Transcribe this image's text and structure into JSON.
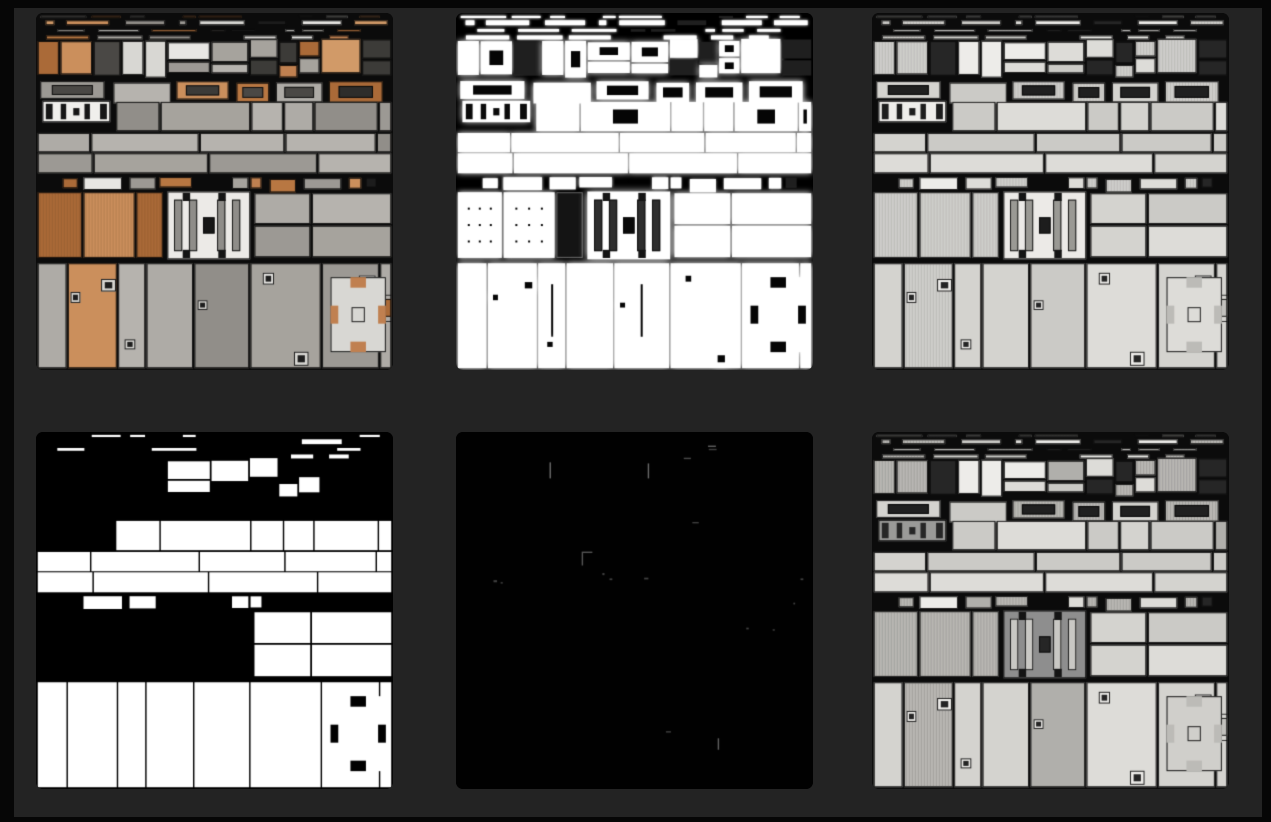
{
  "page": {
    "background": "#060606",
    "panel_background": "#232323"
  },
  "gallery": {
    "rows": 2,
    "cols": 3,
    "tile_size_px": 357,
    "seed": 7,
    "tiles": [
      {
        "name": "albedo-color-atlas",
        "mode": "albedo",
        "bg": "#0b0b0b"
      },
      {
        "name": "height-glow-atlas",
        "mode": "height",
        "bg": "#000000"
      },
      {
        "name": "roughness-light-atlas",
        "mode": "rough",
        "bg": "#0b0b0b"
      },
      {
        "name": "metal-mask-atlas",
        "mode": "mask",
        "bg": "#000000"
      },
      {
        "name": "emissive-dark-atlas",
        "mode": "emissive",
        "bg": "#010101"
      },
      {
        "name": "roughness-contrast-atlas",
        "mode": "rough2",
        "bg": "#0b0b0b"
      }
    ],
    "palette": {
      "grays": [
        "#a6a39d",
        "#9c9994",
        "#aeaba6",
        "#b6b3ae",
        "#918e89"
      ],
      "oranges": [
        "#c08050",
        "#b87742",
        "#cb8f5c",
        "#aa6a38",
        "#d19a68"
      ],
      "darks": [
        "#1c1c1c",
        "#2e2d2b",
        "#3c3b38",
        "#4a4845"
      ],
      "lights": [
        "#e7e6e3",
        "#d8d7d3"
      ],
      "rough_lights": [
        "#dddcd8",
        "#d4d3cf",
        "#cbcac6"
      ],
      "glow": "#ffffff",
      "seam": "rgba(8,8,8,0.9)"
    },
    "emissive_marks": [
      {
        "x": 0.262,
        "y": 0.085,
        "w": 0.004,
        "h": 0.045,
        "a": 0.5
      },
      {
        "x": 0.537,
        "y": 0.088,
        "w": 0.004,
        "h": 0.042,
        "a": 0.5
      },
      {
        "x": 0.638,
        "y": 0.072,
        "w": 0.02,
        "h": 0.004,
        "a": 0.35
      },
      {
        "x": 0.706,
        "y": 0.038,
        "w": 0.022,
        "h": 0.004,
        "a": 0.45
      },
      {
        "x": 0.708,
        "y": 0.047,
        "w": 0.022,
        "h": 0.004,
        "a": 0.3
      },
      {
        "x": 0.662,
        "y": 0.252,
        "w": 0.018,
        "h": 0.004,
        "a": 0.3
      },
      {
        "x": 0.352,
        "y": 0.335,
        "w": 0.03,
        "h": 0.004,
        "a": 0.4
      },
      {
        "x": 0.352,
        "y": 0.339,
        "w": 0.004,
        "h": 0.035,
        "a": 0.4
      },
      {
        "x": 0.41,
        "y": 0.395,
        "w": 0.006,
        "h": 0.006,
        "a": 0.3
      },
      {
        "x": 0.43,
        "y": 0.41,
        "w": 0.008,
        "h": 0.005,
        "a": 0.3
      },
      {
        "x": 0.105,
        "y": 0.415,
        "w": 0.01,
        "h": 0.006,
        "a": 0.3
      },
      {
        "x": 0.125,
        "y": 0.42,
        "w": 0.006,
        "h": 0.005,
        "a": 0.25
      },
      {
        "x": 0.527,
        "y": 0.408,
        "w": 0.012,
        "h": 0.005,
        "a": 0.3
      },
      {
        "x": 0.965,
        "y": 0.41,
        "w": 0.008,
        "h": 0.005,
        "a": 0.3
      },
      {
        "x": 0.945,
        "y": 0.478,
        "w": 0.005,
        "h": 0.005,
        "a": 0.3
      },
      {
        "x": 0.813,
        "y": 0.548,
        "w": 0.007,
        "h": 0.005,
        "a": 0.3
      },
      {
        "x": 0.887,
        "y": 0.552,
        "w": 0.006,
        "h": 0.005,
        "a": 0.25
      },
      {
        "x": 0.588,
        "y": 0.838,
        "w": 0.014,
        "h": 0.004,
        "a": 0.3
      },
      {
        "x": 0.733,
        "y": 0.858,
        "w": 0.004,
        "h": 0.032,
        "a": 0.45
      }
    ]
  }
}
